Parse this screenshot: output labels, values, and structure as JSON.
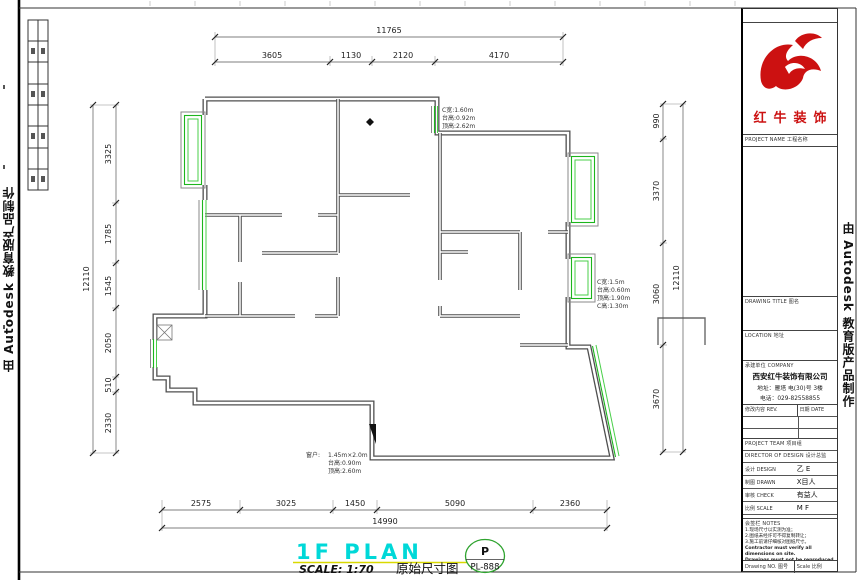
{
  "watermark": {
    "text": "由 Autodesk 教育版产品制作"
  },
  "brand": {
    "name": "红牛装饰"
  },
  "plan": {
    "title": "1F PLAN",
    "scale_label": "SCALE: 1:70",
    "subtitle": "原始尺寸图",
    "badge": {
      "letter": "P",
      "code": "PL-888"
    },
    "annotations": {
      "window_top": [
        "C宽:1.60m",
        "台高:0.92m",
        "顶高:2.62m"
      ],
      "window_right": [
        "C宽:1.5m",
        "台高:0.60m",
        "顶高:1.90m",
        "C高:1.30m"
      ],
      "window_bottom_label": "窗户:",
      "window_bottom": [
        "1.45m×2.0m",
        "台高:0.90m",
        "顶高:2.60m"
      ]
    },
    "dimensions": {
      "top": {
        "overall": "11765",
        "segments": [
          "3605",
          "1130",
          "2120",
          "4170"
        ]
      },
      "bottom": {
        "overall": "14990",
        "segments": [
          "2575",
          "3025",
          "1450",
          "5090",
          "2360"
        ]
      },
      "left": {
        "overall": "12110",
        "segments": [
          "3325",
          "1785",
          "1545",
          "2050",
          "510",
          "2330"
        ]
      },
      "right": {
        "overall": "12110",
        "segments": [
          "990",
          "3370",
          "3060",
          "3670"
        ]
      }
    }
  },
  "title_block": {
    "project_label": "PROJECT NAME 工程名称",
    "drawing_title_label": "DRAWING TITLE 图名",
    "location_label": "LOCATION 地址",
    "company_label": "承建单位 COMPANY",
    "company_name": "西安红牛装饰有限公司",
    "company_address": "地址：雁塔 电(30)号 3楼",
    "company_phone": "电话：029-82558855",
    "revision": {
      "col1": "修改内容 REV.",
      "col2": "日期 DATE"
    },
    "team_label": "PROJECT TEAM 项目组",
    "director_label": "DIRECTOR OF DESIGN 设计总监",
    "fields": [
      {
        "label": "设计 DESIGN",
        "value": "乙 E"
      },
      {
        "label": "制图 DRAWN",
        "value": "X目人"
      },
      {
        "label": "审核 CHECK",
        "value": "有益人"
      },
      {
        "label": "比例 SCALE",
        "value": "M F"
      },
      {
        "label": "日期 DATE",
        "value": "C K"
      }
    ],
    "notes_label": "会签栏 NOTES",
    "notes": [
      "1.现场尺寸以实测为准；",
      "2.图纸未经许可不得复制转让；",
      "3.施工前请仔细核对图纸尺寸。",
      "Contractor must verify all dimensions on site.",
      "Drawings must not be reproduced without consent.",
      "Deviations must be reported immediately in writing."
    ],
    "drawing_no_label": "Drawing NO. 图号",
    "scale_field_label": "Scale 比例"
  }
}
